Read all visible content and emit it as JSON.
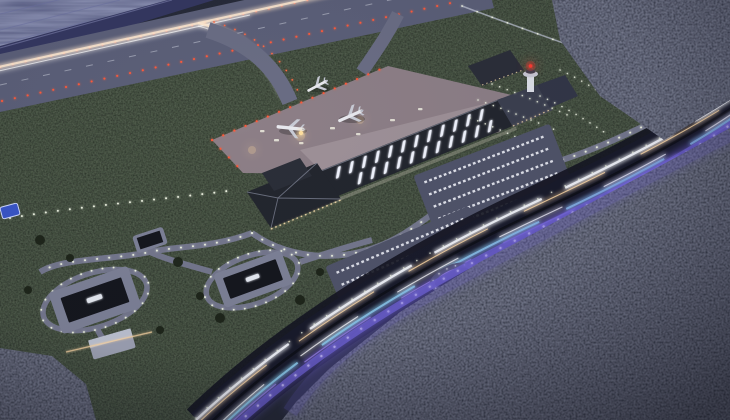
{
  "scene": {
    "description": "Night-time aerial architectural rendering of a regional airport: diagonal runway with red edge lights along the sea, curved taxiway with aircraft light streak, pink-grey apron with three parked airliners, long terminal with glowing roof skylights, control tower with red beacon, lit gardens, car parks, service compound with dotted street lights, and a curved highway with white, cyan and violet light trails cutting through dark forest.",
    "time_of_day": "night",
    "aircraft_on_apron": 3,
    "runway_edge_light_color": "red-orange",
    "highway_light_trails": [
      "white",
      "warm",
      "cyan",
      "violet"
    ],
    "landcover": [
      "sea",
      "grass airfield",
      "dense forest"
    ]
  },
  "palette": {
    "water": "#535880",
    "water_ripple": "#6b70a0",
    "embankment": "#343760",
    "runway": "#5b5f78",
    "runway_light": "#ff5a3a",
    "grass": "#232a21",
    "apron": "#8d7f87",
    "apron_wash": "#b0a4aa",
    "terminal_roof": "#23262e",
    "skylight": "#f2f5ff",
    "facade_warm": "#ffe3b0",
    "aircraft": "#e9eaef",
    "beacon": "#ff3b30",
    "road": "#75788e",
    "road_light": "#eef3e2",
    "parking": "#50546a",
    "car_white": "#eef0f8",
    "pavement": "#7e8298",
    "building_roof": "#15171e",
    "highway": "#191b2b",
    "trail_white": "#f3f5fc",
    "trail_warm": "#ffd9a6",
    "trail_cyan": "#8fd8f0",
    "trail_violet": "#a78bf0",
    "wall_violet": "#6f63d8",
    "forest": "#1d2030",
    "forest_top": "#242737",
    "blue_pad": "#3a56c8",
    "streak_warm": "#ffe9d0"
  }
}
